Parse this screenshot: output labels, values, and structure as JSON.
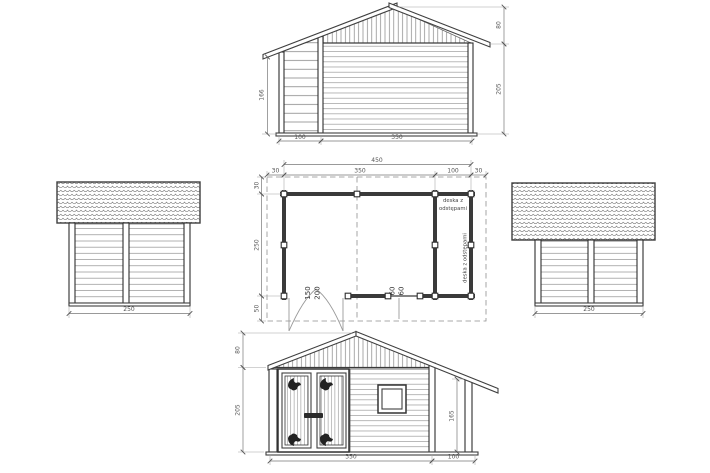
{
  "colors": {
    "ink": "#3a3a3a",
    "dim_text": "#555555",
    "background": "#ffffff"
  },
  "rear_elevation": {
    "porch_height": "166",
    "roof_height": "80",
    "wall_height": "205",
    "porch_width": "100",
    "main_width": "350"
  },
  "floor_plan": {
    "total_width": "450",
    "overhang_left": "30",
    "main_width": "350",
    "porch_width": "100",
    "overhang_right": "30",
    "overhang_top": "30",
    "depth": "250",
    "overhang_bottom": "50",
    "door_dim_1": "150",
    "door_dim_2": "200",
    "window_dim_1": "60",
    "window_dim_2": "60",
    "porch_note_line1": "deska z",
    "porch_note_line2": "odstępami",
    "porch_note_vertical": "deska z odstępami"
  },
  "left_elevation": {
    "width": "250"
  },
  "right_elevation": {
    "width": "250"
  },
  "front_elevation": {
    "roof_height": "80",
    "wall_height": "205",
    "porch_height": "165",
    "main_width": "350",
    "porch_width": "100"
  }
}
